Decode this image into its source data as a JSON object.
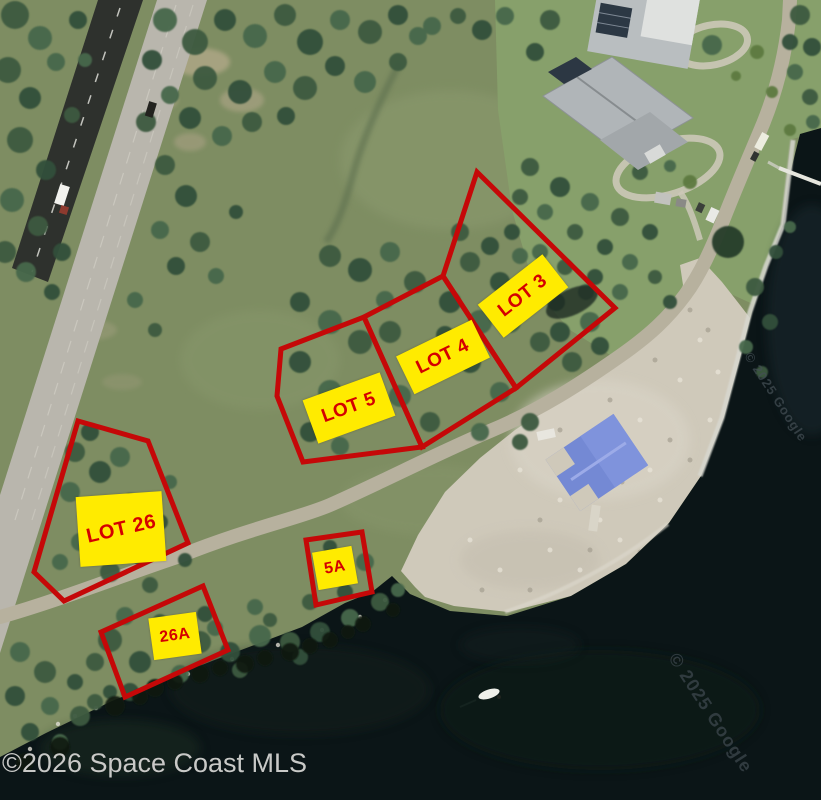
{
  "image_type": "aerial-satellite-lot-map",
  "lots": [
    {
      "id": "lot-26",
      "label": "LOT 26"
    },
    {
      "id": "lot-5",
      "label": "LOT 5"
    },
    {
      "id": "lot-4",
      "label": "LOT 4"
    },
    {
      "id": "lot-3",
      "label": "LOT 3"
    },
    {
      "id": "lot-5a",
      "label": "5A"
    },
    {
      "id": "lot-26a",
      "label": "26A"
    }
  ],
  "watermarks": {
    "mls": "©2026 Space Coast MLS",
    "google": "© 2025 Google"
  },
  "colors": {
    "lot_outline": "#c50808",
    "label_background": "#ffeb00",
    "label_text": "#d40000",
    "water": "#0b1517",
    "mls_watermark_text": "#d3d3d1"
  }
}
